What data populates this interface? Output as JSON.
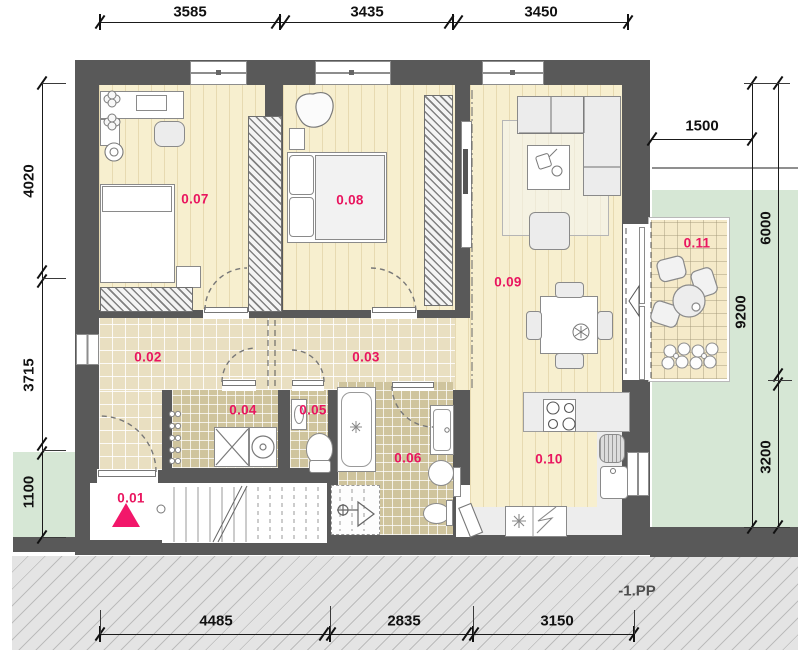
{
  "plan": {
    "level_label": "-1.PP",
    "rooms": [
      {
        "number": "0.01",
        "type": "entrance"
      },
      {
        "number": "0.02",
        "type": "hall"
      },
      {
        "number": "0.03",
        "type": "hall"
      },
      {
        "number": "0.04",
        "type": "shower-laundry"
      },
      {
        "number": "0.05",
        "type": "wc"
      },
      {
        "number": "0.06",
        "type": "bathroom"
      },
      {
        "number": "0.07",
        "type": "bedroom"
      },
      {
        "number": "0.08",
        "type": "bedroom"
      },
      {
        "number": "0.09",
        "type": "living-room"
      },
      {
        "number": "0.10",
        "type": "kitchen"
      },
      {
        "number": "0.11",
        "type": "terrace"
      }
    ],
    "dimensions": {
      "top": [
        "3585",
        "3435",
        "3450"
      ],
      "right_top": "1500",
      "left": [
        "4020",
        "3715",
        "1100"
      ],
      "right": [
        "6000",
        "9200",
        "3200"
      ],
      "bottom": [
        "4485",
        "2835",
        "3150"
      ]
    },
    "legend_symbols": {
      "entrance_marker": "filled-triangle",
      "refrigerator": "snowflake-asterisk",
      "dishwasher": "zigzag-line",
      "stove": "four-burner-circles",
      "shower_drain": "circle-and-triangle",
      "door_swing": "dashed-arc"
    },
    "colors": {
      "wall": "#595959",
      "room_label": "#e9155f",
      "entrance_marker": "#f2176a",
      "wood_floor": "#f7efcf",
      "hall_tile": "#e9dfc1",
      "bath_tile": "#cfc49d",
      "terrace_tile": "#f5eac9",
      "garden_green": "#d6e7d5",
      "ground_hatch": "#e4e4e4",
      "dimension_text": "#111111"
    }
  }
}
